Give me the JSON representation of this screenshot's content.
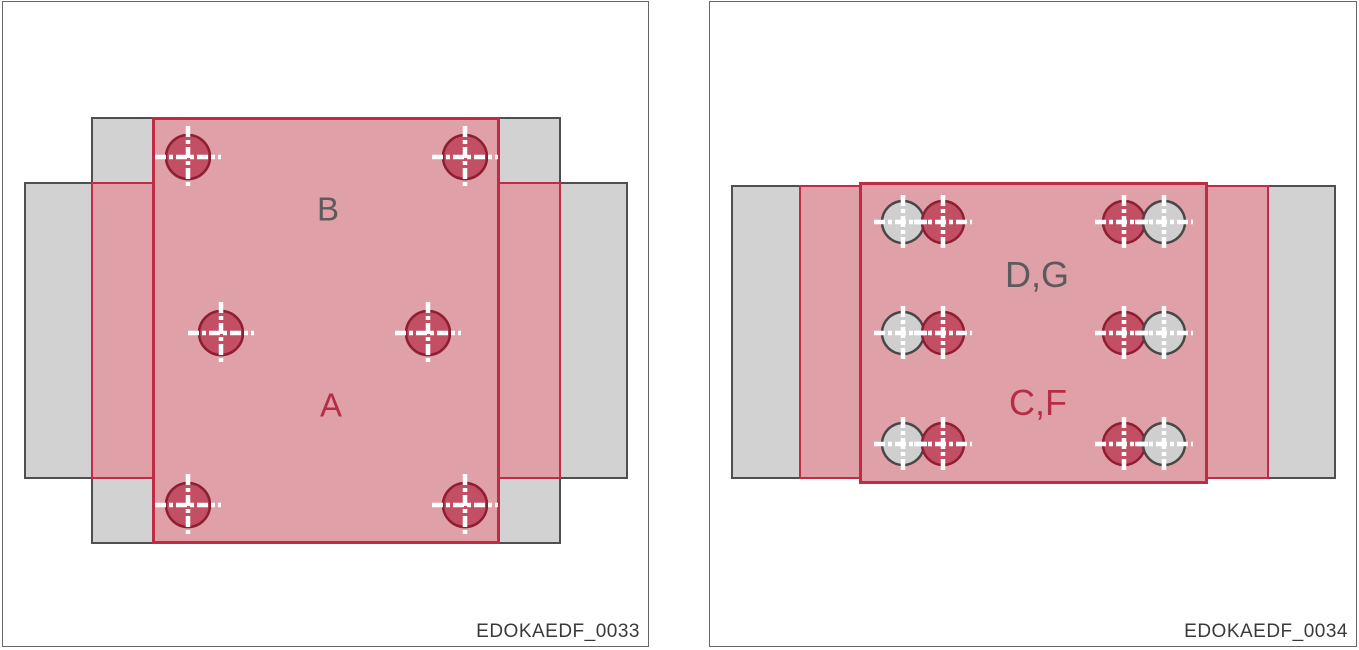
{
  "figure": {
    "description_labels_left": [
      "B",
      "A"
    ],
    "description_labels_right": [
      "D,G",
      "C,F"
    ]
  },
  "colors": {
    "background": "#ffffff",
    "panel_border": "#666666",
    "steel_gray_fill": "#d2d2d2",
    "steel_gray_edge": "#4f4f4f",
    "overlay_pink_fill": "#dfa0a8",
    "overlay_red_edge": "#c02b45",
    "crosshair": "#ffffff",
    "label_gray": "#5b5b5b",
    "label_red": "#b52e46",
    "caption": "#3a3a3a",
    "marker_red": {
      "fill": "#c24f63",
      "ring": "#8e1e31"
    },
    "marker_gray": {
      "fill": "#cfcfcf",
      "ring": "#474747"
    }
  },
  "panels": [
    {
      "caption": "EDOKAEDF_0033",
      "labels": [
        {
          "text": "B",
          "tone": "gray"
        },
        {
          "text": "A",
          "tone": "red"
        }
      ],
      "marker_style": {
        "radius": 22,
        "arm": 33
      },
      "markers": [
        {
          "cx": 185,
          "cy": 155,
          "kind": "red"
        },
        {
          "cx": 462,
          "cy": 155,
          "kind": "red"
        },
        {
          "cx": 218,
          "cy": 331,
          "kind": "red"
        },
        {
          "cx": 425,
          "cy": 331,
          "kind": "red"
        },
        {
          "cx": 185,
          "cy": 503,
          "kind": "red"
        },
        {
          "cx": 462,
          "cy": 503,
          "kind": "red"
        }
      ]
    },
    {
      "caption": "EDOKAEDF_0034",
      "labels": [
        {
          "text": "D,G",
          "tone": "gray"
        },
        {
          "text": "C,F",
          "tone": "red"
        }
      ],
      "marker_style": {
        "radius": 21,
        "arm": 29
      },
      "markers": [
        {
          "cx": 193,
          "cy": 220,
          "kind": "gray"
        },
        {
          "cx": 233,
          "cy": 220,
          "kind": "red"
        },
        {
          "cx": 414,
          "cy": 220,
          "kind": "red"
        },
        {
          "cx": 454,
          "cy": 220,
          "kind": "gray"
        },
        {
          "cx": 193,
          "cy": 331,
          "kind": "gray"
        },
        {
          "cx": 233,
          "cy": 331,
          "kind": "red"
        },
        {
          "cx": 414,
          "cy": 331,
          "kind": "red"
        },
        {
          "cx": 454,
          "cy": 331,
          "kind": "gray"
        },
        {
          "cx": 193,
          "cy": 442,
          "kind": "gray"
        },
        {
          "cx": 233,
          "cy": 442,
          "kind": "red"
        },
        {
          "cx": 414,
          "cy": 442,
          "kind": "red"
        },
        {
          "cx": 454,
          "cy": 442,
          "kind": "gray"
        }
      ]
    }
  ]
}
